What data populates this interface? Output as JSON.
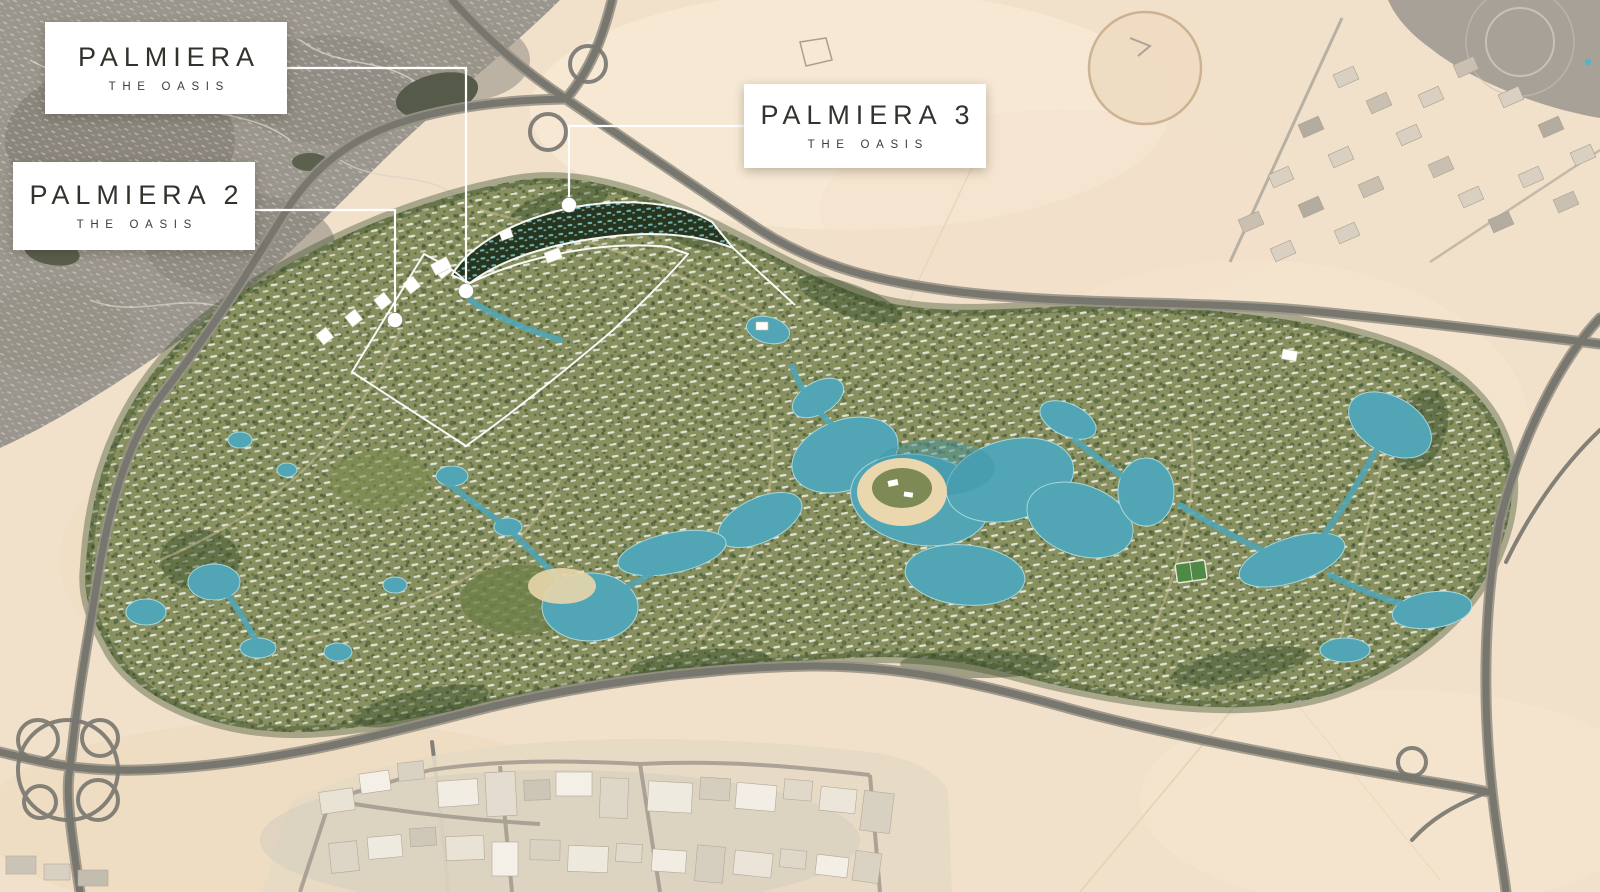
{
  "map_labels": {
    "palmiera": {
      "title": "PALMIERA",
      "subtitle": "THE OASIS"
    },
    "palmiera2": {
      "title": "PALMIERA 2",
      "subtitle": "THE OASIS"
    },
    "palmiera3": {
      "title": "PALMIERA 3",
      "subtitle": "THE OASIS"
    }
  },
  "markers": {
    "palmiera_marker": "white-dot-on-plan",
    "palmiera2_marker": "white-dot-on-plan",
    "palmiera3_marker": "white-dot-on-plan"
  },
  "colors": {
    "desert": "#f2e1ca",
    "development_green": "#87905e",
    "tree_green": "#3c4f2c",
    "water_teal": "#51a5b4",
    "road_gray": "#77766f",
    "city_gray": "#9b968d",
    "label_bg": "#ffffff",
    "label_text": "#33332d"
  }
}
